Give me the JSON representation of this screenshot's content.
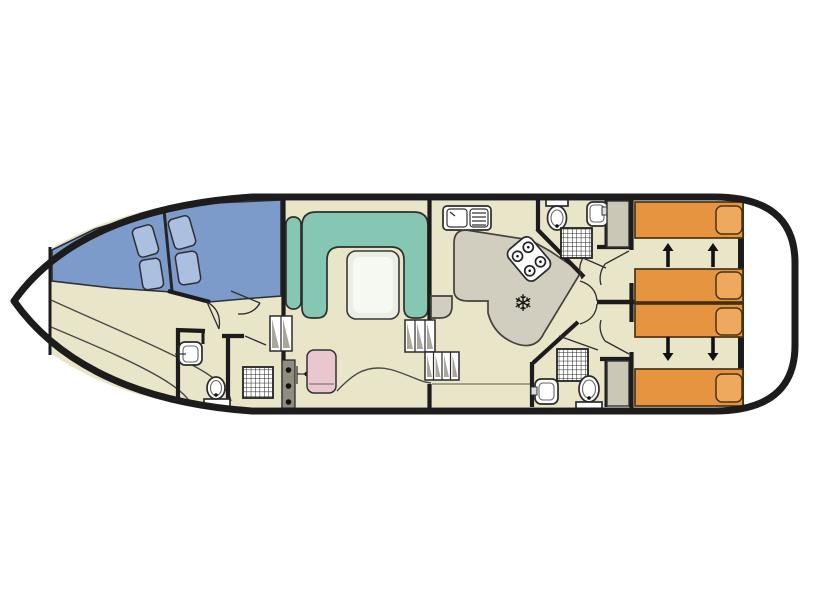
{
  "diagram": {
    "kind": "houseboat-floor-plan"
  },
  "icons": {
    "fridge_snowflake": "❄"
  },
  "colors": {
    "hull_outline": "#1c1c1c",
    "deck_white": "#ffffff",
    "floor": "#e9e5c9",
    "wall": "#1c1c1c",
    "bow_bed_blue": "#7d9bca",
    "pillow_blue": "#abbfe0",
    "sofa_teal": "#85c7b2",
    "table_top": "#e9efe4",
    "table_inner": "#f5f9f1",
    "counter_gray": "#d1cec0",
    "wardrobe_gray": "#cac7b6",
    "bed_orange": "#e79441",
    "pillow_orange": "#efa95c",
    "helm_seat_pink": "#eac7cf",
    "console_gray": "#8f8d80",
    "step_shade": "#a9a79b",
    "fixture_white": "#ffffff",
    "arrow_black": "#111111"
  }
}
